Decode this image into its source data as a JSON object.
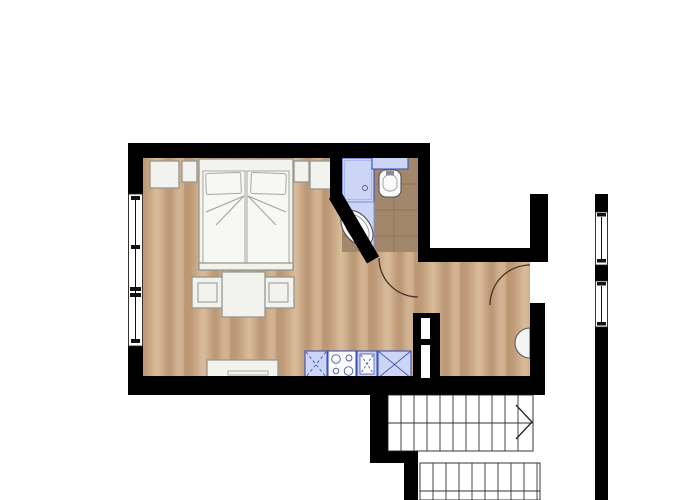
{
  "app": {
    "name": "apartment-floor-plan",
    "description": "Studio apartment floor plan: bedroom/living room with kitchenette, corner bathroom, hallway with entry door, exterior corridor and staircase"
  },
  "colors": {
    "wall": "#000000",
    "floor_wood": "#c9a786",
    "bathroom_tile": "#a3876a",
    "fixture_fill": "#ccd5f5",
    "fixture_border": "#4053b8",
    "furniture_fill": "#f2f2ef",
    "stair_outline": "#222222",
    "door_arc": "#4a3322",
    "background": "#ffffff"
  },
  "rooms": [
    {
      "id": "bedroom-living",
      "fixtures": [
        "double-bed",
        "pillows",
        "nightstand-left",
        "nightstand-right",
        "wardrobe-left",
        "wardrobe-right",
        "dining-table",
        "chair-left",
        "chair-right",
        "sideboard",
        "kitchenette"
      ]
    },
    {
      "id": "bathroom",
      "fixtures": [
        "shower",
        "corner-bathtub",
        "toilet-with-cistern",
        "tiled-floor"
      ]
    },
    {
      "id": "hallway",
      "fixtures": [
        "entry-door",
        "wall-basin",
        "service-shaft"
      ]
    },
    {
      "id": "exterior",
      "fixtures": [
        "corridor",
        "staircase"
      ]
    }
  ],
  "kitchen": {
    "units": [
      "base-cabinet-dashed-x",
      "stove-four-burners",
      "sink",
      "refrigerator-solid-x"
    ]
  },
  "windows": {
    "left_wall": 1,
    "right_corridor_wall": 2
  },
  "doors": {
    "bathroom_door": 1,
    "entry_door": 1
  },
  "stairs": {
    "flights": 2,
    "upper_treads": 10,
    "lower_treads": 9,
    "direction_arrow": "right"
  }
}
